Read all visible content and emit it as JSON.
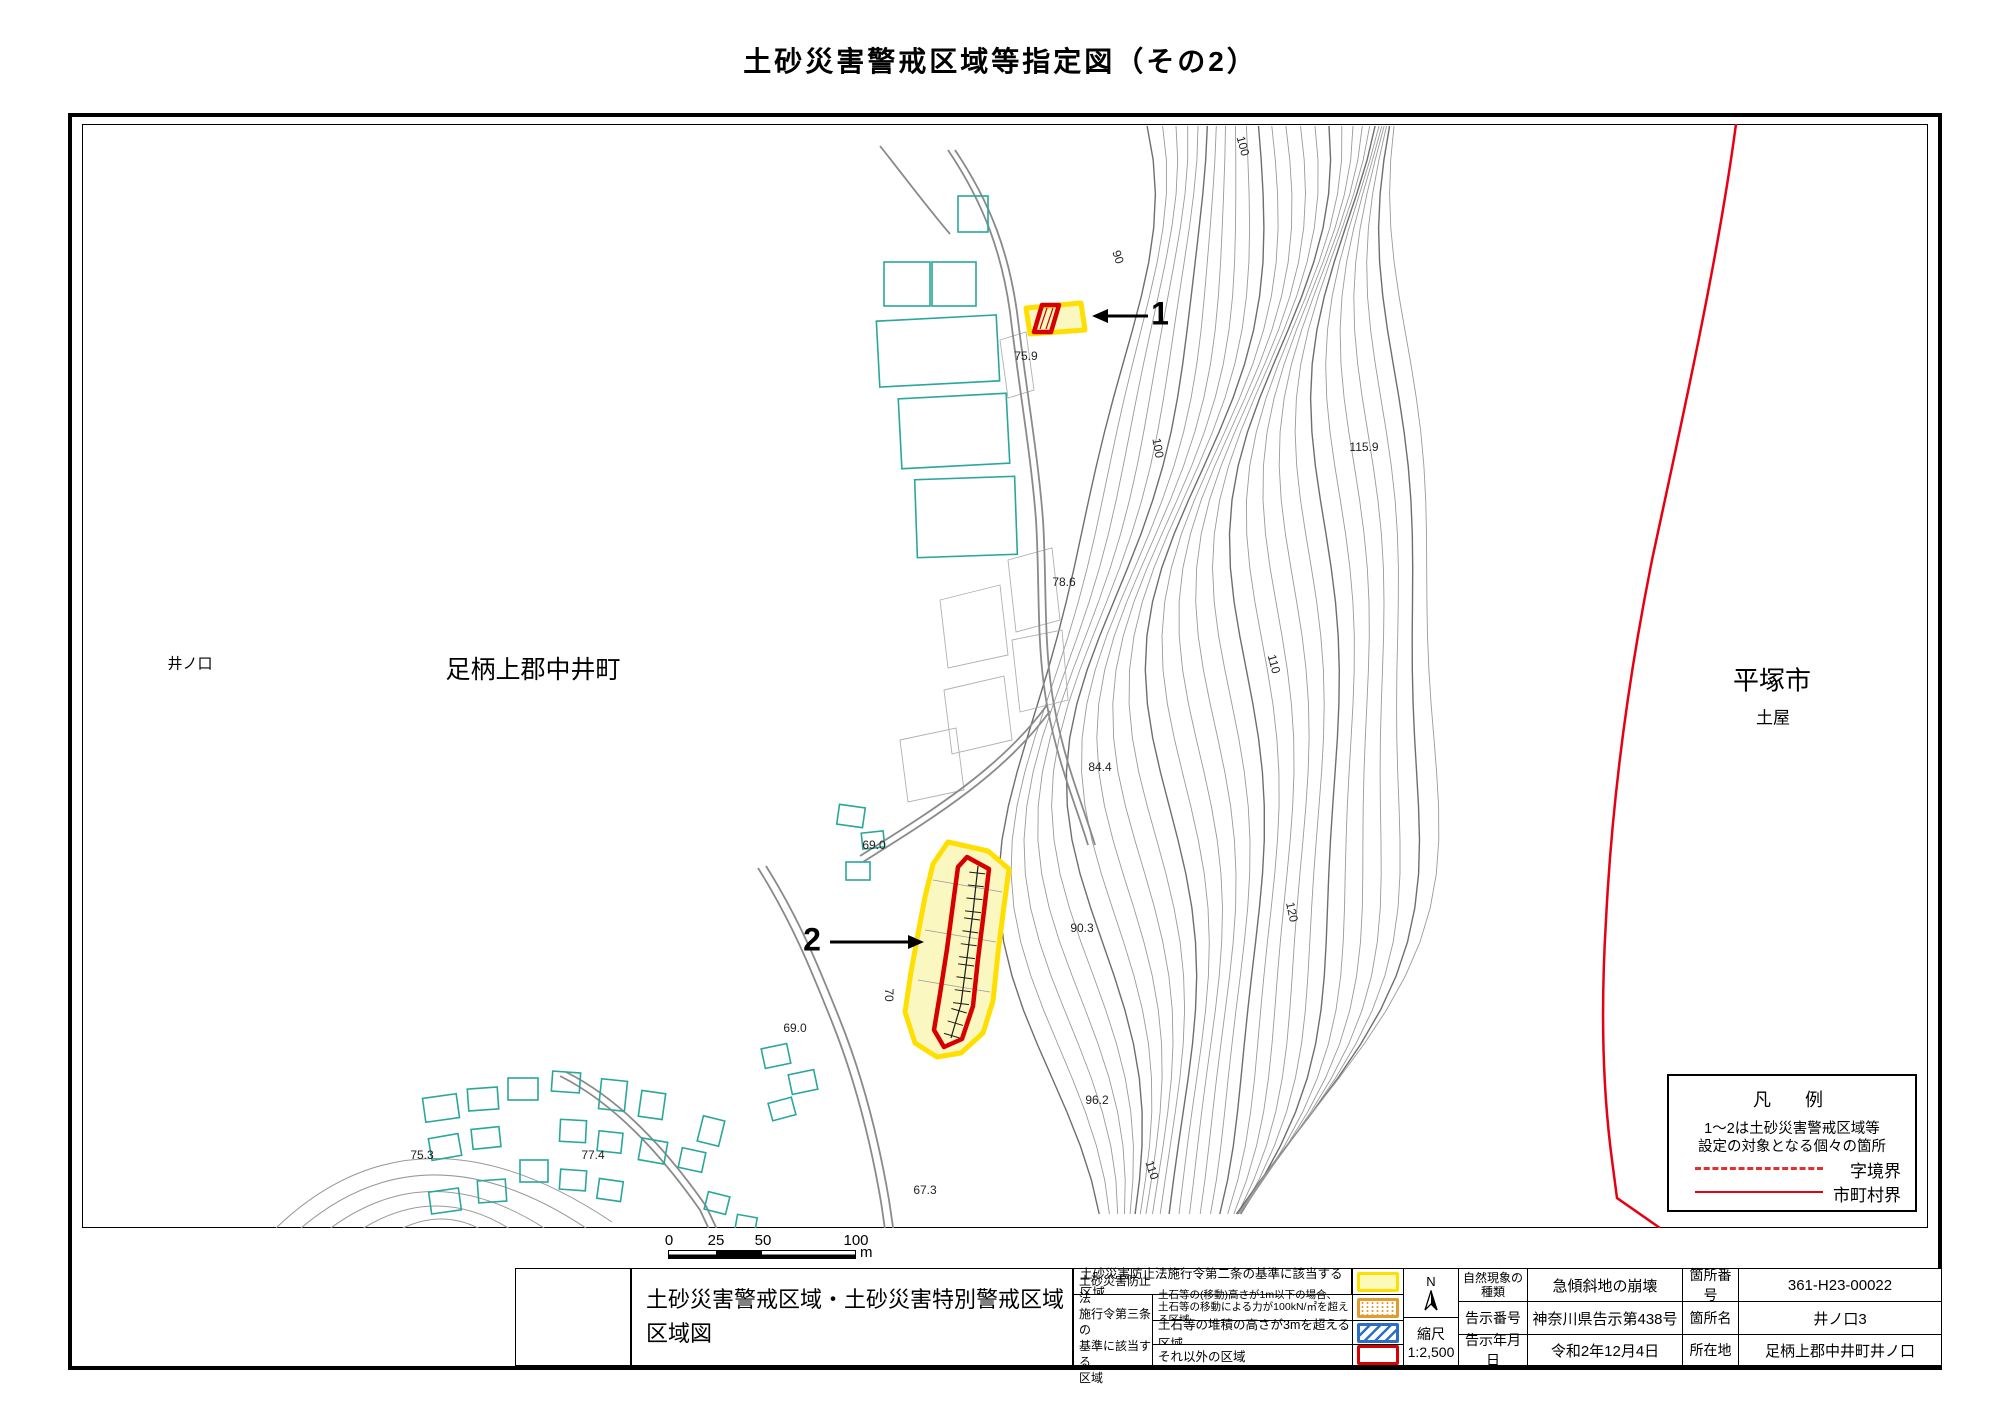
{
  "title": "土砂災害警戒区域等指定図（その2）",
  "map": {
    "area_labels": {
      "left_small": "井ノ口",
      "left_large": "足柄上郡中井町",
      "right_large": "平塚市",
      "right_small": "土屋"
    },
    "markers": [
      {
        "label": "1"
      },
      {
        "label": "2"
      }
    ],
    "spot_elevations": [
      {
        "text": "100",
        "x": 1243,
        "y": 146,
        "rot": 75
      },
      {
        "text": "90",
        "x": 1118,
        "y": 257,
        "rot": 72
      },
      {
        "text": "75.9",
        "x": 1026,
        "y": 356,
        "rot": 0
      },
      {
        "text": "115.9",
        "x": 1364,
        "y": 447,
        "rot": 0
      },
      {
        "text": "100",
        "x": 1158,
        "y": 448,
        "rot": 80
      },
      {
        "text": "78.6",
        "x": 1064,
        "y": 582,
        "rot": 0
      },
      {
        "text": "110",
        "x": 1274,
        "y": 664,
        "rot": 75
      },
      {
        "text": "84.4",
        "x": 1100,
        "y": 767,
        "rot": 0
      },
      {
        "text": "69.0",
        "x": 874,
        "y": 845,
        "rot": 0
      },
      {
        "text": "90.3",
        "x": 1082,
        "y": 928,
        "rot": 0
      },
      {
        "text": "120",
        "x": 1292,
        "y": 912,
        "rot": 78
      },
      {
        "text": "70",
        "x": 889,
        "y": 995,
        "rot": 90
      },
      {
        "text": "69.0",
        "x": 795,
        "y": 1028,
        "rot": 0
      },
      {
        "text": "96.2",
        "x": 1097,
        "y": 1100,
        "rot": 0
      },
      {
        "text": "110",
        "x": 1152,
        "y": 1170,
        "rot": 72
      },
      {
        "text": "67.3",
        "x": 925,
        "y": 1190,
        "rot": 0
      },
      {
        "text": "75.3",
        "x": 422,
        "y": 1155,
        "rot": 0
      },
      {
        "text": "77.4",
        "x": 593,
        "y": 1155,
        "rot": 0
      }
    ],
    "legend": {
      "title": "凡　例",
      "note_line1": "1～2は土砂災害警戒区域等",
      "note_line2": "設定の対象となる個々の箇所",
      "items": [
        {
          "label": "字境界"
        },
        {
          "label": "市町村界"
        }
      ]
    },
    "scale_bar": {
      "ticks": [
        "0",
        "25",
        "50",
        "100"
      ],
      "unit": "m"
    }
  },
  "title_block": {
    "sheet_title_line1": "土砂災害警戒区域・土砂災害特別警戒区域",
    "sheet_title_line2": "区域図",
    "criteria": {
      "row_article2": {
        "text": "土砂災害防止法施行令第二条の基準に該当する区域"
      },
      "article3_label_lines": [
        "土砂災害防止法",
        "施行令第三条の",
        "基準に該当する",
        "区域"
      ],
      "rows": [
        {
          "line1": "土石等の(移動)高さが1m以下の場合、",
          "line2": "土石等の移動による力が100kN/㎡を超える区域"
        },
        {
          "line1": "土石等の堆積の高さが3mを超える区域",
          "line2": ""
        },
        {
          "line1": "それ以外の区域",
          "line2": ""
        }
      ]
    },
    "compass": "N",
    "scale_label": "縮尺",
    "scale_value": "1:2,500",
    "info_rows": [
      {
        "label": "自然現象の種類",
        "value": "急傾斜地の崩壊",
        "label2": "箇所番号",
        "value2": "361-H23-00022"
      },
      {
        "label": "告示番号",
        "value": "神奈川県告示第438号",
        "label2": "箇所名",
        "value2": "井ノ口3"
      },
      {
        "label": "告示年月日",
        "value": "令和2年12月4日",
        "label2": "所在地",
        "value2": "足柄上郡中井町井ノ口"
      }
    ]
  },
  "colors": {
    "warning_zone_fill": "#fbf7c0",
    "warning_zone_border": "#ffdf00",
    "special_zone_border": "#d60000",
    "municipal_boundary": "#e60012",
    "aza_boundary": "#e0312e",
    "building_outline": "#2aa79b",
    "contour": "#9a9a9a"
  }
}
